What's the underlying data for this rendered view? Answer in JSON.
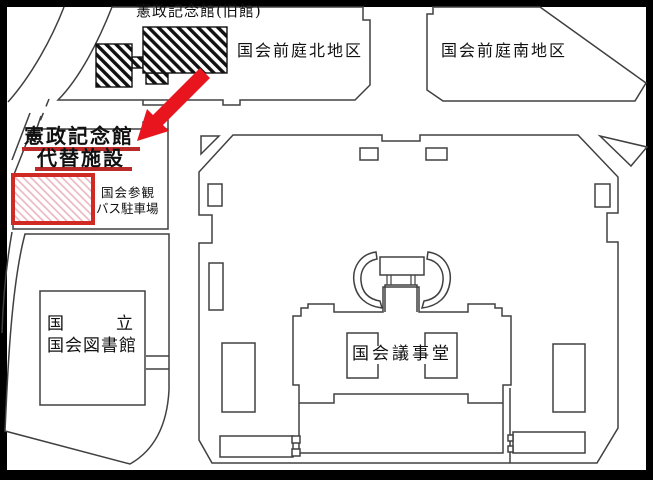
{
  "map": {
    "labels": {
      "kensei_old_hall": "憲政記念館(旧館)",
      "north_garden": "国会前庭北地区",
      "south_garden": "国会前庭南地区",
      "kensei_line1": "憲政記念館",
      "kensei_line2": "代替施設",
      "bus_parking_line1": "国会参観",
      "bus_parking_line2": "バス駐車場",
      "library_line1": "国　　立",
      "library_line2": "国会図書館",
      "diet_building": "国会議事堂"
    },
    "colors": {
      "arrow_red": "#e8141e",
      "highlight_border_red": "#cf2a24",
      "underline_red": "#b92a28",
      "hatch_pink": "#ecb9c1",
      "outline_gray": "#404040",
      "frame_black": "#000000",
      "background": "#ffffff"
    }
  }
}
